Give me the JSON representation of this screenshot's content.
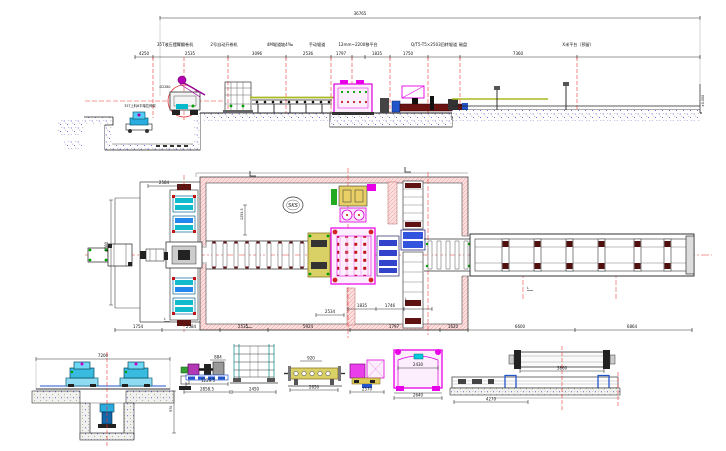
{
  "elevation": {
    "overall_dim": "36765",
    "dims": [
      "4250",
      "2535",
      "3096",
      "2536",
      "1797",
      "1835",
      "1750",
      "7360"
    ],
    "equipment_labels": [
      "35T液压摆臂翻卷机",
      "2号自动开卷机",
      "4M辊道坡4‰",
      "手动辊道",
      "12mm~2200移平台",
      "Q/T5-T5×2503回转辊道",
      "磁盘",
      "X米平台（预留）"
    ],
    "machine_note": "35T上料6平轴拉伸架",
    "circle_dim": "Ø2280",
    "level_mark": "±0.000"
  },
  "plan": {
    "logo_text": "SKS",
    "dim_top_left": "2584",
    "dim_vertical": "1293.5",
    "dim_left": "4780",
    "dim_mid": "2534",
    "dims_inner": [
      "1835",
      "1746"
    ],
    "dims_bottom": [
      "1754",
      "2584",
      "2535",
      "5924",
      "1797",
      "1620",
      "6600",
      "6864"
    ],
    "section_mark": "L"
  },
  "details": {
    "uncoiler_section": {
      "dim_top": "7200",
      "dim_right": "970"
    },
    "drive_unit": {
      "dim_top": "884",
      "dim_mid": "1229.5",
      "dim_bottom": "2858.5"
    },
    "stand_frame": {
      "dim_bottom": "2450"
    },
    "roller_table": {
      "dim_top": "920",
      "dim_bottom": "2650"
    },
    "pinch_unit": {
      "dim_bottom": "2570"
    },
    "straightener": {
      "dim_inner": "2430",
      "dim_bottom": "2640"
    },
    "outlet_table": {
      "dim_top": "3860",
      "dim_bottom": "4270"
    }
  }
}
